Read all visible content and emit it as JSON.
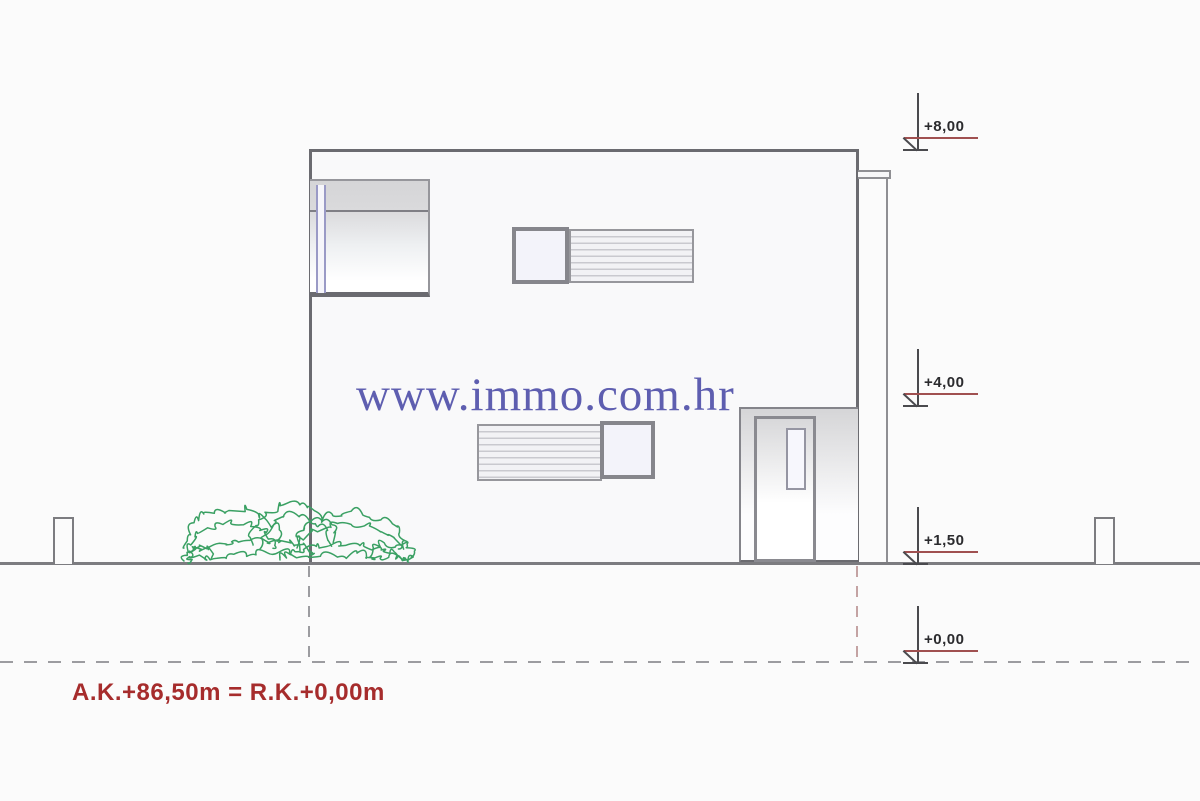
{
  "watermark": {
    "text": "www.immo.com.hr",
    "color": "#5e5eb0"
  },
  "annotation": {
    "text": "A.K.+86,50m = R.K.+0,00m",
    "color": "#a62c2c"
  },
  "elevation_markers": [
    {
      "label": "+8,00"
    },
    {
      "label": "+4,00"
    },
    {
      "label": "+1,50"
    },
    {
      "label": "+0,00"
    }
  ],
  "colors": {
    "outline": "#6b6b70",
    "frame_gray": "#8a8a90",
    "level_line_red": "#a05050",
    "bush_green": "#3aa063",
    "background": "#fbfbfb",
    "glass_tint": "#f3f3fa"
  }
}
